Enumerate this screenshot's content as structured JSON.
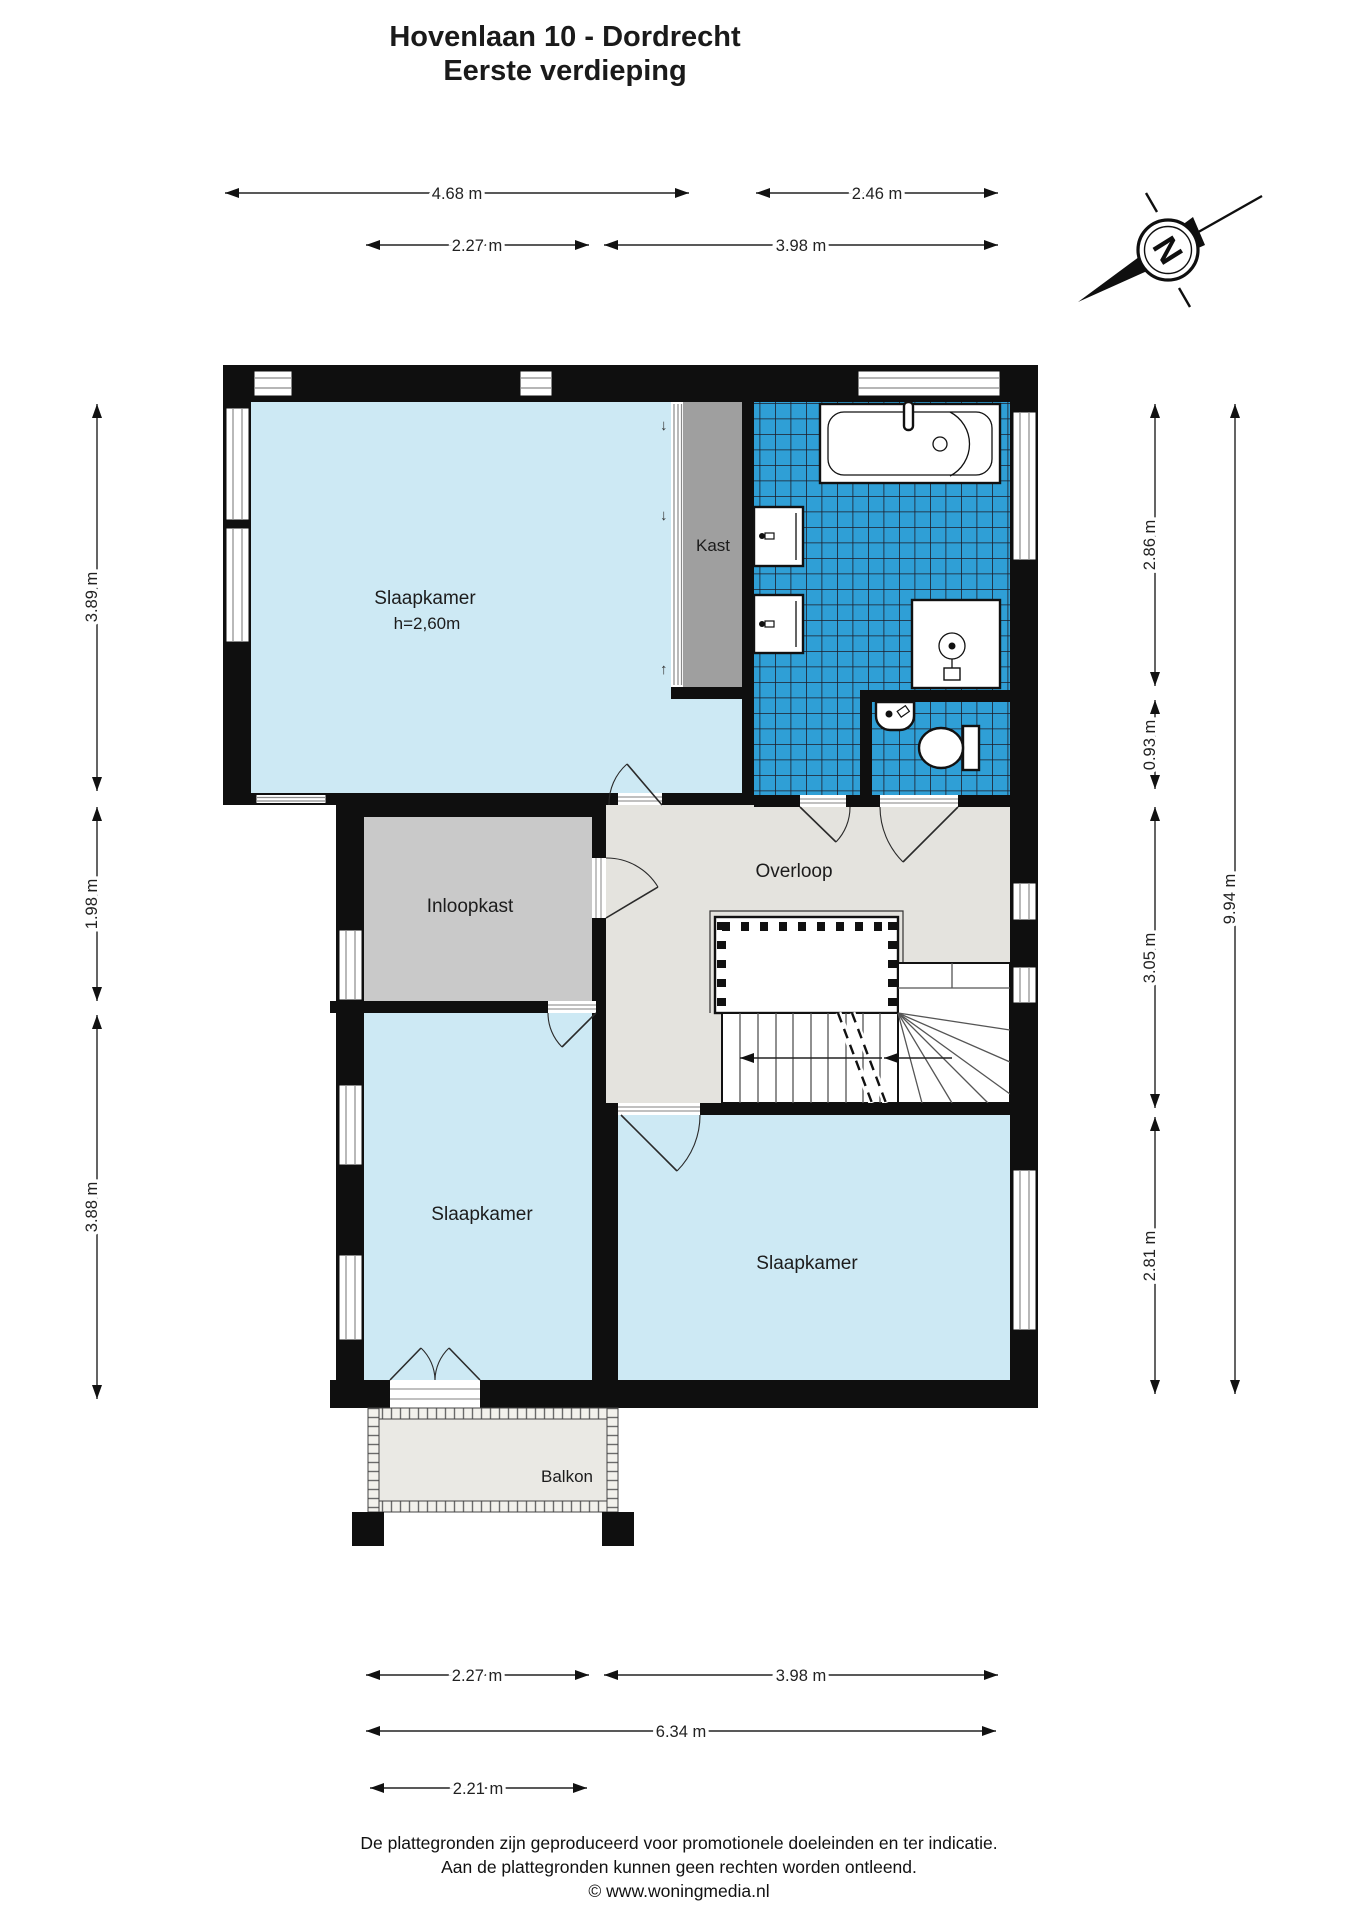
{
  "title": {
    "line1": "Hovenlaan 10 - Dordrecht",
    "line2": "Eerste verdieping"
  },
  "compass": {
    "north_label": "N"
  },
  "rooms": {
    "slaapkamer1": {
      "label": "Slaapkamer",
      "ceiling_height": "h=2,60m"
    },
    "kast": {
      "label": "Kast"
    },
    "inloopkast": {
      "label": "Inloopkast"
    },
    "overloop": {
      "label": "Overloop"
    },
    "slaapkamer2": {
      "label": "Slaapkamer"
    },
    "slaapkamer3": {
      "label": "Slaapkamer"
    },
    "balkon": {
      "label": "Balkon"
    }
  },
  "icons": {
    "down_arrow": "↓",
    "up_arrow": "↑"
  },
  "dimensions": {
    "top_row1_left": "4.68 m",
    "top_row1_right": "2.46 m",
    "top_row2_left": "2.27 m",
    "top_row2_right": "3.98 m",
    "left_top": "3.89 m",
    "left_middle": "1.98 m",
    "left_bottom": "3.88 m",
    "right_section1": "2.86 m",
    "right_section2": "0.93 m",
    "right_section3": "3.05 m",
    "right_section4": "2.81 m",
    "right_total": "9.94 m",
    "bottom_row1_left": "2.27 m",
    "bottom_row1_right": "3.98 m",
    "bottom_total": "6.34 m",
    "bottom_balcony": "2.21 m"
  },
  "footer": {
    "line1": "De plattegronden zijn geproduceerd voor promotionele doeleinden en ter indicatie.",
    "line2": "Aan de plattegronden kunnen geen rechten worden ontleend.",
    "line3": "© www.woningmedia.nl"
  },
  "colors": {
    "room_fill": "#cde9f4",
    "tile_fill": "#2f9fd6",
    "tile_grid": "#1d1d28",
    "kast_fill": "#9f9f9f",
    "inloopkast_fill": "#c9c9c9",
    "overloop_fill": "#e4e3de",
    "balkon_fill": "#eae9e4",
    "wall": "#0f0f0f"
  }
}
